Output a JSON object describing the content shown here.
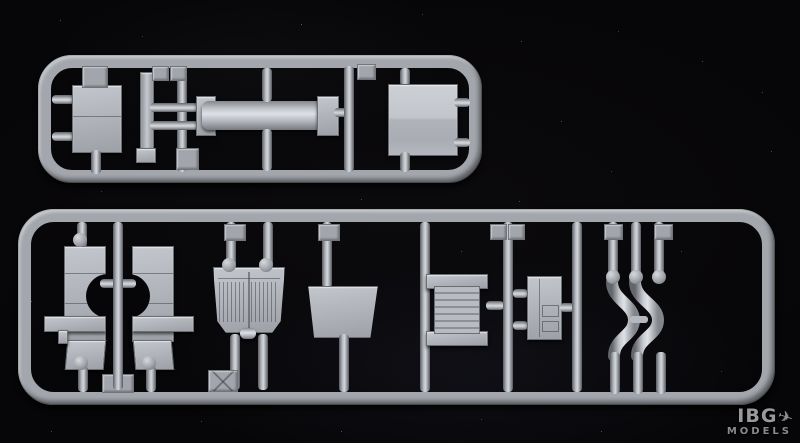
{
  "image": {
    "description": "Photograph of a light-grey injection-molded model kit sprue (parts frame) on a black background",
    "background_color": "#060507",
    "plastic_color": "#aeb2b8",
    "highlight_color": "#d6dade",
    "shadow_color": "#55585d"
  },
  "watermark": {
    "brand": "IBG",
    "sub": "MODELS",
    "plane_glyph": "✈"
  },
  "sprue": {
    "sections": [
      {
        "name": "upper-runner-frame",
        "parts": [
          "rectangular-plate",
          "thin-strip",
          "cylindrical-beam",
          "square-bent-plate",
          "number-tags"
        ]
      },
      {
        "name": "lower-runner-frame",
        "parts": [
          "hull-side-left",
          "hull-side-right",
          "engine-deck-grille-plate",
          "trapezoid-plate",
          "ribbed-radiator-plate",
          "small-hatch-panel",
          "curved-fender-pair",
          "number-tags"
        ]
      }
    ],
    "tag_count": 12,
    "material": "grey styrene"
  }
}
